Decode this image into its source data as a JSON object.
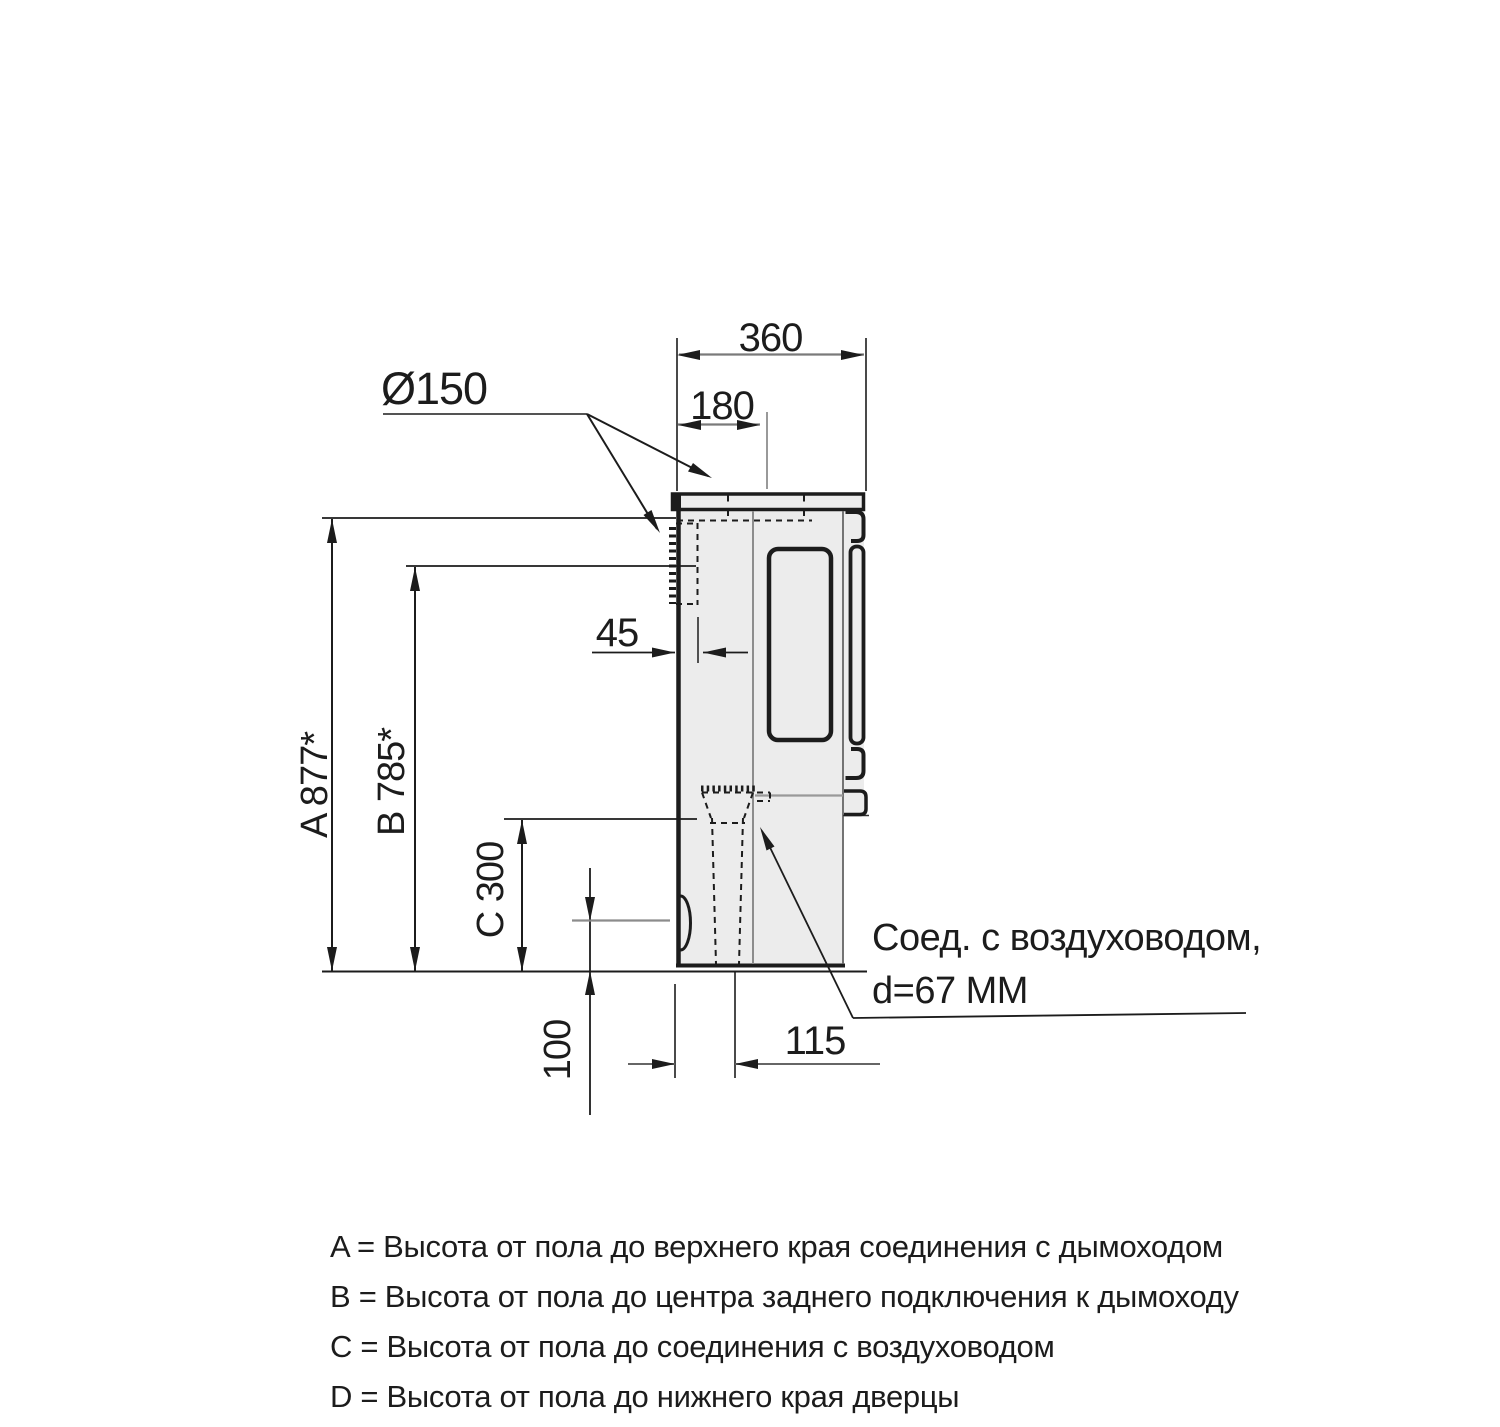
{
  "drawing": {
    "dim_depth_total": "360",
    "dim_flue_center_from_rear": "180",
    "dim_flue_diameter": "Ø150",
    "dim_rear_outlet_offset": "45",
    "dim_height_a": "A 877*",
    "dim_height_b": "B 785*",
    "dim_height_c": "C 300",
    "dim_floor_clearance": "100",
    "dim_duct_center_offset": "115",
    "note_air_duct_line1": "Соед. с воздуховодом,",
    "note_air_duct_line2": "d=67 ММ"
  },
  "legend": {
    "items": [
      "A = Высота от пола до верхнего края соединения с дымоходом",
      "B = Высота от пола до центра заднего подключения к дымоходу",
      "C = Высота от пола до соединения с воздуховодом",
      "D = Высота от пола до нижнего края дверцы"
    ]
  },
  "colors": {
    "line": "#1c1c1c",
    "body_fill": "#ececec",
    "seam": "#8c8c8c",
    "dim_line": "#7a7a7a",
    "background": "#ffffff"
  }
}
